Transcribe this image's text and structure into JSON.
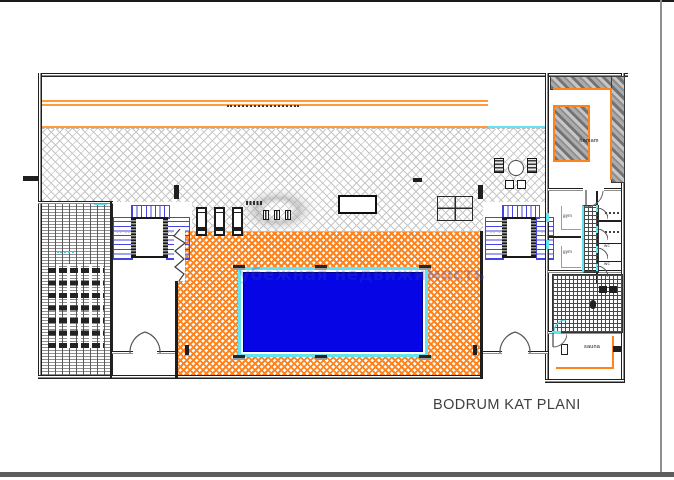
{
  "drawing": {
    "title": "BODRUM KAT PLANI",
    "watermark": "убежная недвижимость",
    "rooms": {
      "hamam": "hamam",
      "gym_upper": "gym",
      "gym_lower": "gym",
      "wc_upper": "wc",
      "wc_lower": "wc",
      "sauna": "sauna"
    }
  },
  "colors": {
    "orange": "#ff831d",
    "orange_light": "#ff9b3c",
    "cyan": "#62e3ef",
    "pool_blue": "#0505e6",
    "stair_blue": "#4545e0",
    "hatch_gray": "#c6c6c6",
    "wall_dark": "#1f1f1f",
    "watermark_blue": "rgba(47,66,189,0.29)",
    "title_gray": "#3f3f3f",
    "frame_gray": "#5d5d5d"
  }
}
